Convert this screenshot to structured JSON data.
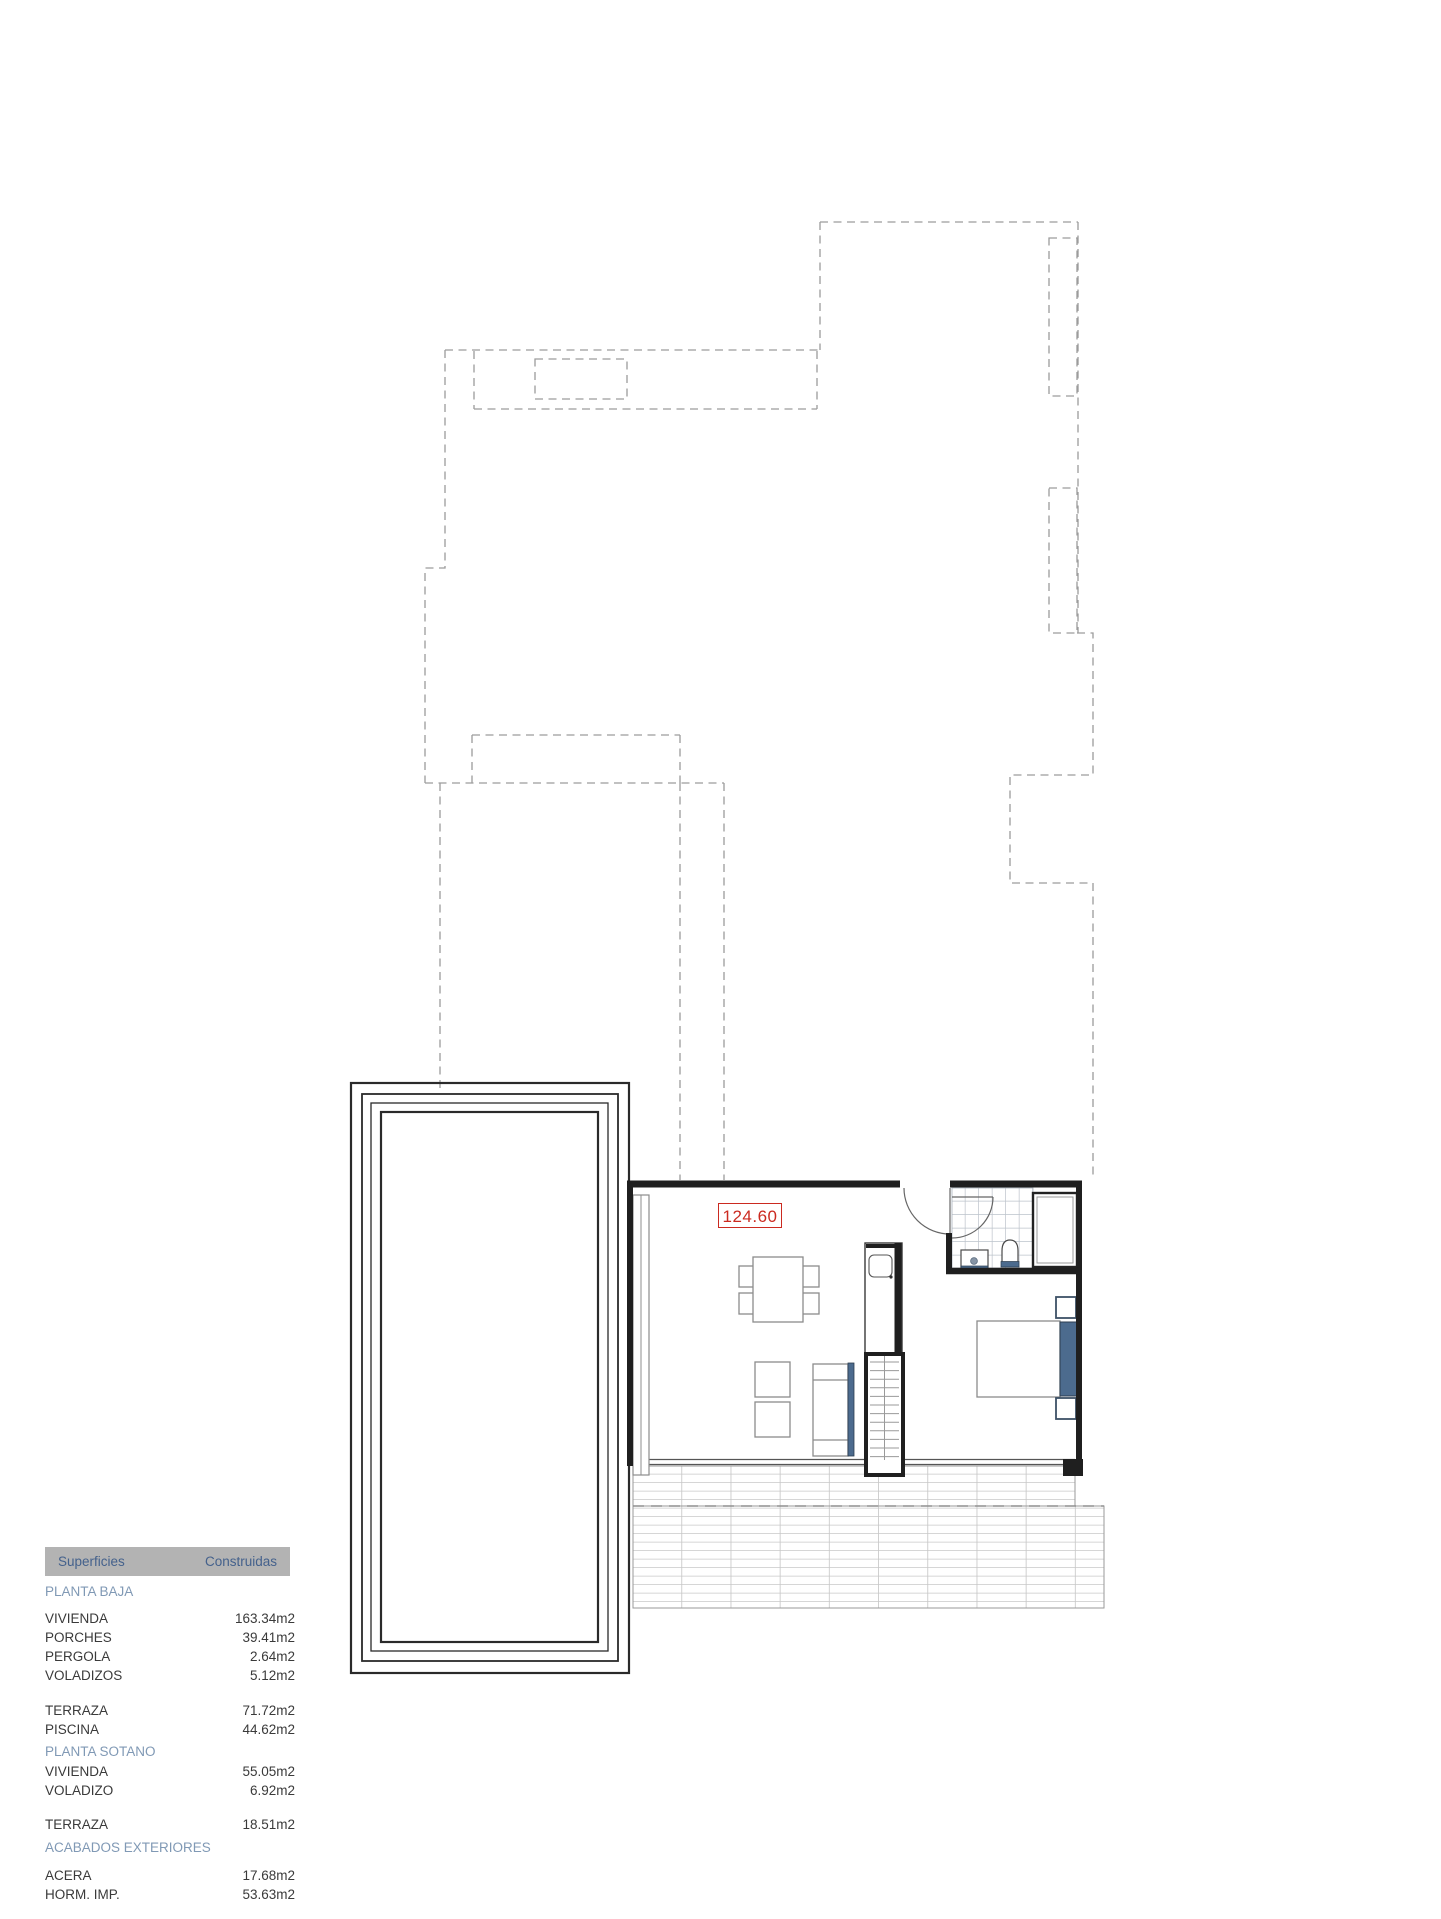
{
  "plan": {
    "area_label": "124.60"
  },
  "areas_table": {
    "header": {
      "left": "Superficies",
      "right": "Construidas"
    },
    "sections": [
      {
        "title": "PLANTA BAJA",
        "groups": [
          {
            "rows": [
              {
                "label": "VIVIENDA",
                "value": "163.34m2"
              },
              {
                "label": "PORCHES",
                "value": "39.41m2"
              },
              {
                "label": "PERGOLA",
                "value": "2.64m2"
              },
              {
                "label": "VOLADIZOS",
                "value": "5.12m2"
              }
            ]
          },
          {
            "rows": [
              {
                "label": "TERRAZA",
                "value": "71.72m2"
              },
              {
                "label": "PISCINA",
                "value": "44.62m2"
              }
            ]
          }
        ]
      },
      {
        "title": "PLANTA SOTANO",
        "groups": [
          {
            "rows": [
              {
                "label": "VIVIENDA",
                "value": "55.05m2"
              },
              {
                "label": "VOLADIZO",
                "value": "6.92m2"
              }
            ]
          },
          {
            "rows": [
              {
                "label": "TERRAZA",
                "value": "18.51m2"
              }
            ]
          }
        ]
      },
      {
        "title": "ACABADOS EXTERIORES",
        "groups": [
          {
            "rows": [
              {
                "label": "ACERA",
                "value": "17.68m2"
              },
              {
                "label": "HORM. IMP.",
                "value": "53.63m2"
              }
            ]
          }
        ]
      }
    ]
  },
  "colors": {
    "accent_blue": "#4c6b8e",
    "label_red": "#cb2a20",
    "header_bar": "#b3b3b3",
    "header_text": "#44618c",
    "section_text": "#8099b5",
    "wall": "#1f1f1f",
    "dashed_boundary": "#9c9c9c"
  }
}
